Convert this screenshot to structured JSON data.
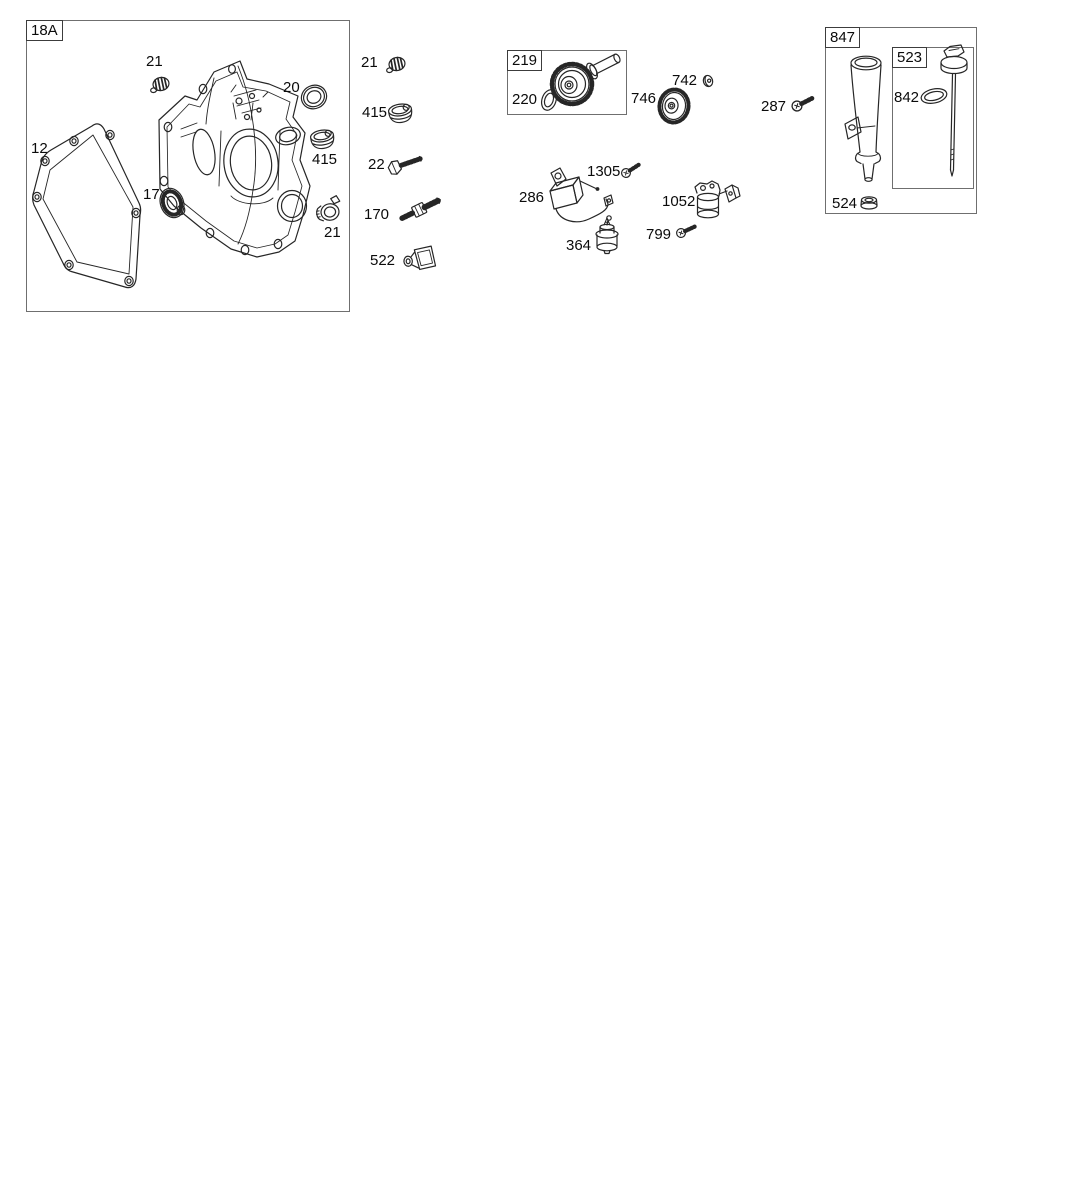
{
  "page": {
    "background": "#ffffff",
    "ink": "#262626",
    "kind": "exploded-parts-diagram"
  },
  "boxes": {
    "b18a": {
      "label": "18A"
    },
    "b219": {
      "label": "219"
    },
    "b847": {
      "label": "847"
    },
    "b523": {
      "label": "523"
    }
  },
  "labels": [
    {
      "text": "21"
    },
    {
      "text": "20"
    },
    {
      "text": "12"
    },
    {
      "text": "415"
    },
    {
      "text": "17"
    },
    {
      "text": "21"
    },
    {
      "text": "21"
    },
    {
      "text": "415"
    },
    {
      "text": "22"
    },
    {
      "text": "170"
    },
    {
      "text": "522"
    },
    {
      "text": "220"
    },
    {
      "text": "742"
    },
    {
      "text": "746"
    },
    {
      "text": "287"
    },
    {
      "text": "1305"
    },
    {
      "text": "286"
    },
    {
      "text": "1052"
    },
    {
      "text": "364"
    },
    {
      "text": "799"
    },
    {
      "text": "842"
    },
    {
      "text": "524"
    }
  ]
}
